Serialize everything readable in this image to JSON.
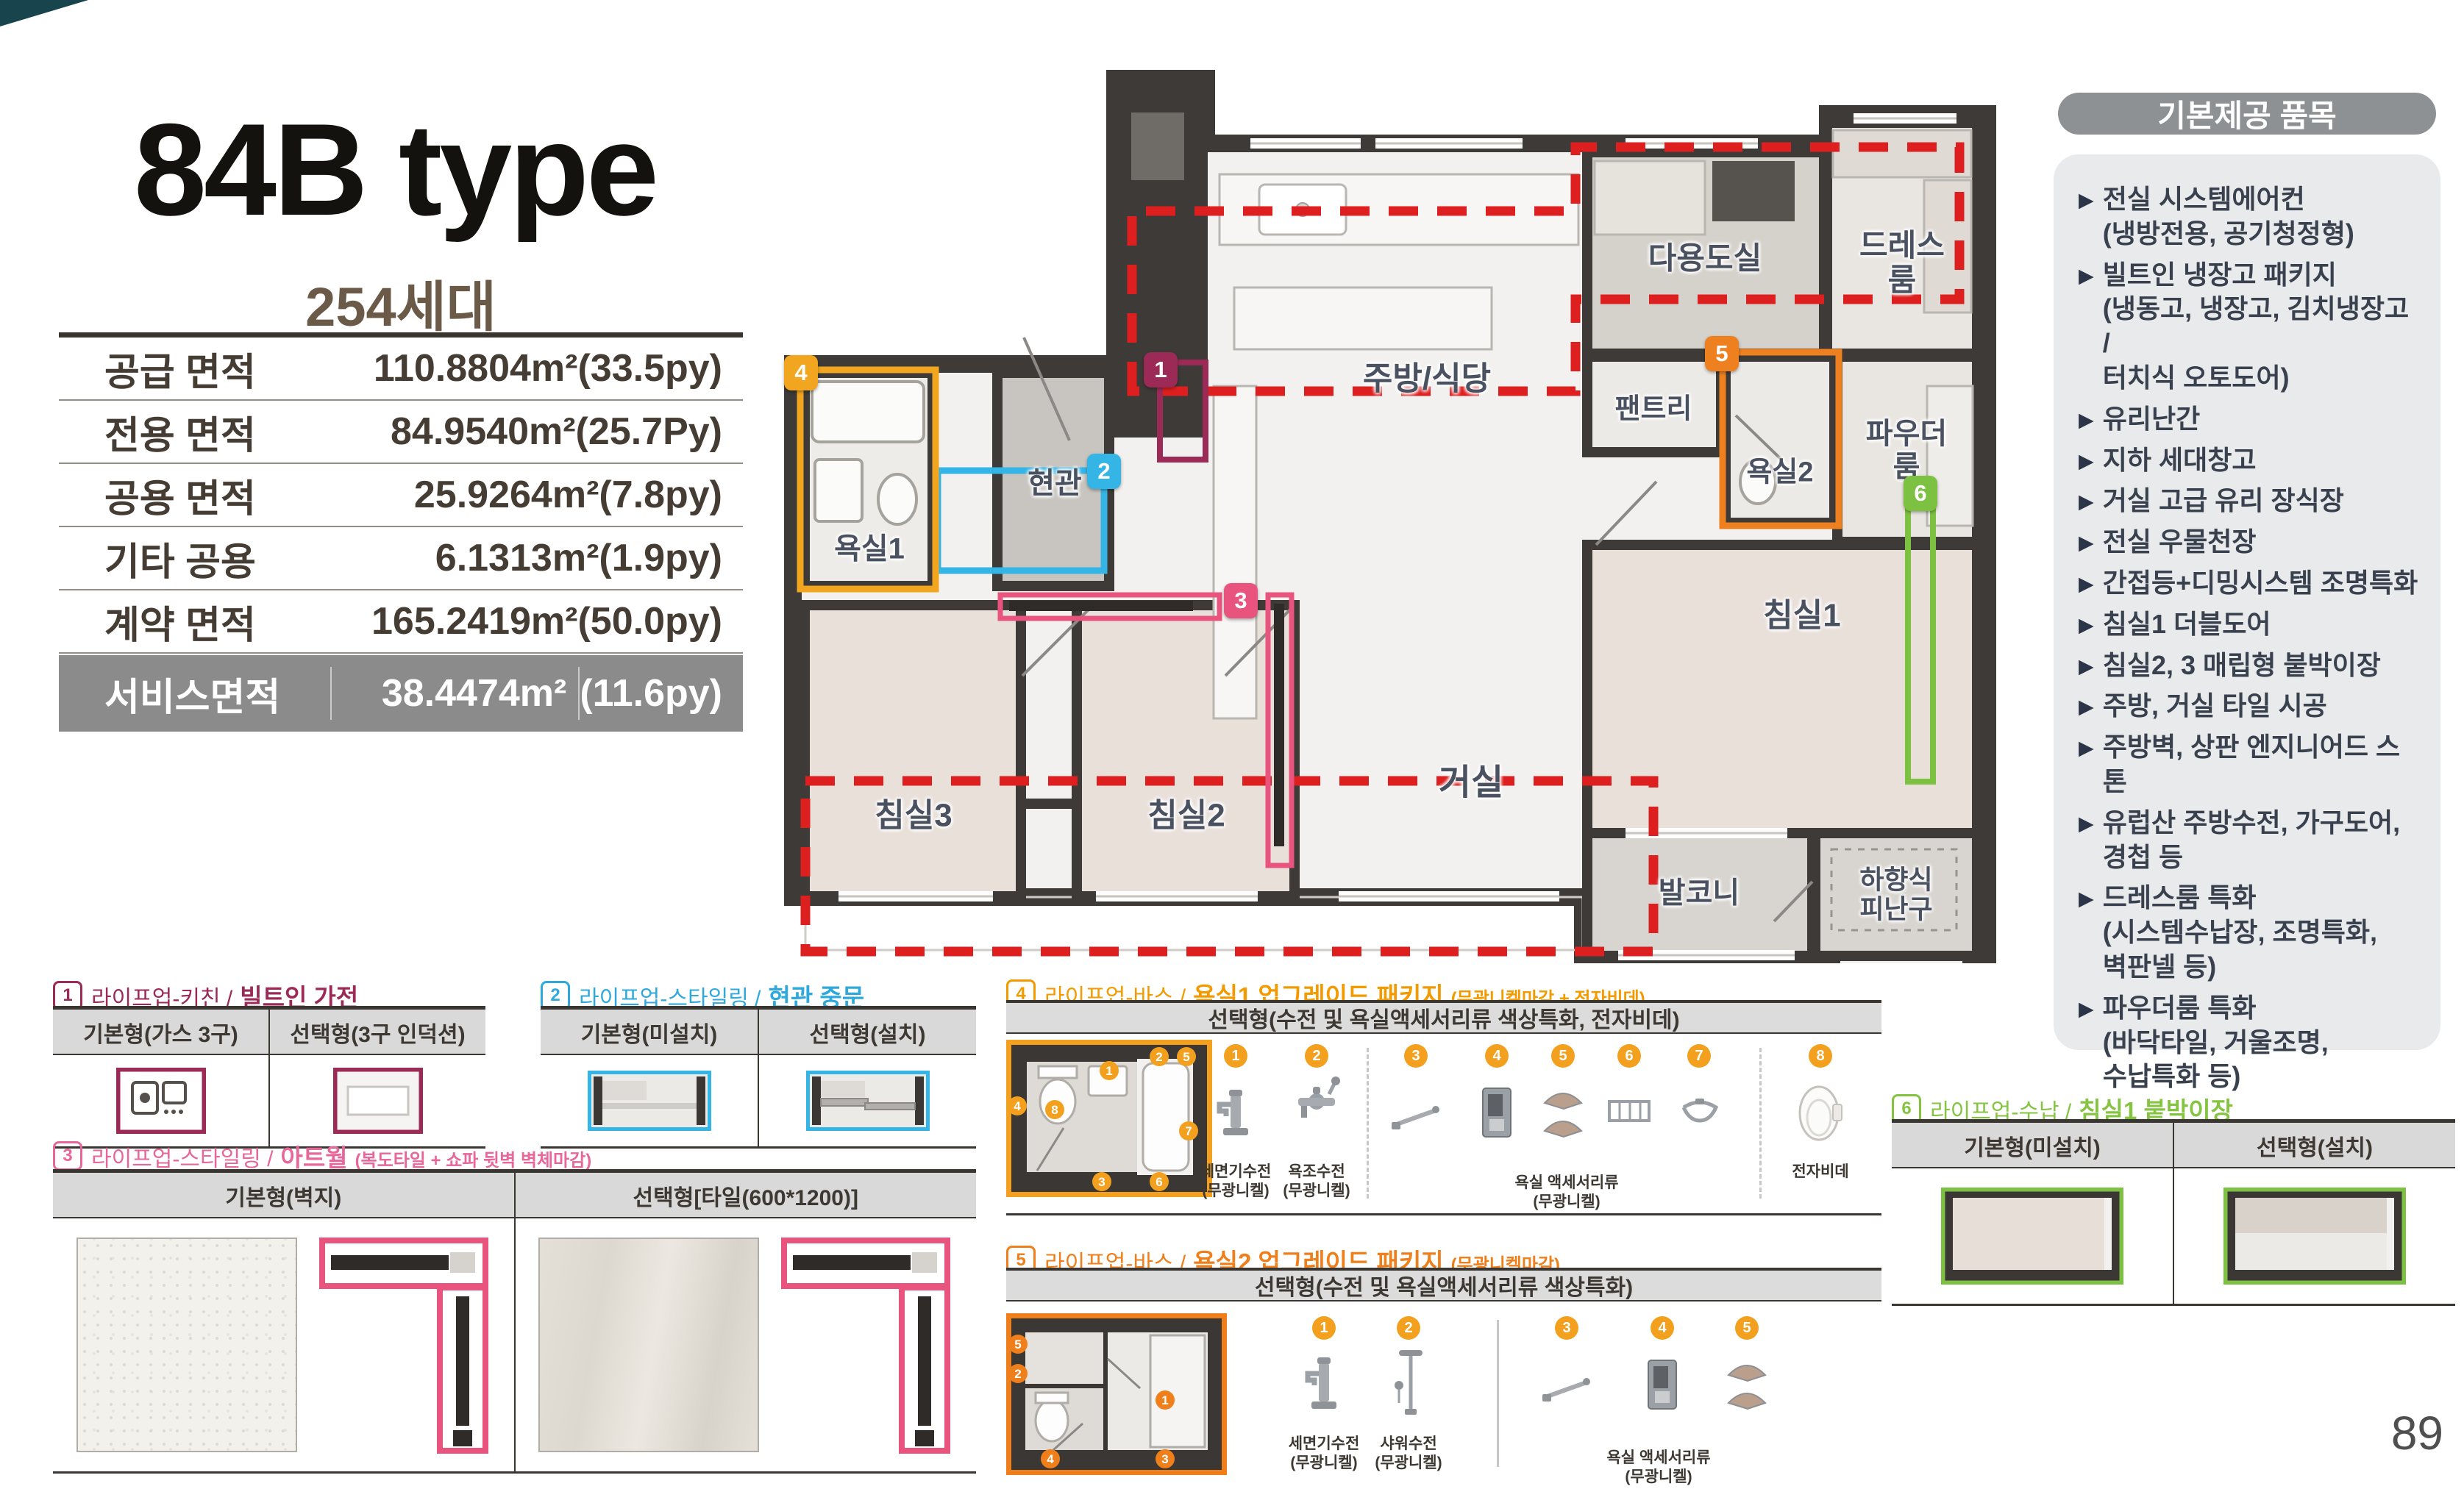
{
  "page": {
    "number": "89"
  },
  "header": {
    "title": "84B type",
    "units": "254세대"
  },
  "area_table": {
    "rows": [
      {
        "label": "공급 면적",
        "value": "110.8804m²",
        "py": "(33.5py)"
      },
      {
        "label": "전용 면적",
        "value": "84.9540m²",
        "py": "(25.7Py)"
      },
      {
        "label": "공용 면적",
        "value": "25.9264m²",
        "py": "(7.8py)"
      },
      {
        "label": "기타 공용",
        "value": "6.1313m²",
        "py": "(1.9py)"
      },
      {
        "label": "계약 면적",
        "value": "165.2419m²",
        "py": "(50.0py)"
      },
      {
        "label": "서비스면적",
        "value": "38.4474m²",
        "py": "(11.6py)"
      }
    ]
  },
  "provided": {
    "title": "기본제공 품목",
    "items": [
      "전실 시스템에어컨\n(냉방전용, 공기청정형)",
      "빌트인 냉장고 패키지\n(냉동고, 냉장고, 김치냉장고 /\n 터치식 오토도어)",
      "유리난간",
      "지하 세대창고",
      "거실 고급 유리 장식장",
      "전실 우물천장",
      "간접등+디밍시스템 조명특화",
      "침실1 더블도어",
      "침실2, 3 매립형 붙박이장",
      "주방, 거실 타일 시공",
      "주방벽, 상판 엔지니어드 스톤",
      "유럽산 주방수전, 가구도어,\n경첩 등",
      "드레스룸 특화\n(시스템수납장, 조명특화,\n 벽판넬 등)",
      "파우더룸 특화\n(바닥타일, 거울조명,\n 수납특화 등)"
    ]
  },
  "floorplan": {
    "rooms": [
      "현관",
      "욕실1",
      "침실3",
      "침실2",
      "거실",
      "주방/식당",
      "다용도실",
      "팬트리",
      "드레스룸",
      "욕실2",
      "파우더룸",
      "침실1",
      "발코니",
      "하향식\n피난구"
    ],
    "markers": [
      "1",
      "2",
      "3",
      "4",
      "5",
      "6"
    ]
  },
  "colors": {
    "s1_maroon": "#9b2a57",
    "s2_cyan": "#35b5e5",
    "s3_pink": "#e8547e",
    "s4_amber": "#f2a01d",
    "s5_orange": "#ef7f1a",
    "s6_green": "#7dc143",
    "red_dash": "#de1f1f",
    "sidebar_gray": "#8e9194",
    "service_row_gray": "#8b8b8b"
  },
  "sections": {
    "s1": {
      "num": "1",
      "cat": "라이프업-키친 /",
      "name": "빌트인 가전",
      "cols": [
        "기본형(가스 3구)",
        "선택형(3구 인덕션)"
      ]
    },
    "s2": {
      "num": "2",
      "cat": "라이프업-스타일링 /",
      "name": "현관 중문",
      "cols": [
        "기본형(미설치)",
        "선택형(설치)"
      ]
    },
    "s3": {
      "num": "3",
      "cat": "라이프업-스타일링 /",
      "name": "아트월",
      "note": "(복도타일 + 쇼파 뒷벽 벽체마감)",
      "cols": [
        "기본형(벽지)",
        "선택형[타일(600*1200)]"
      ]
    },
    "s4": {
      "num": "4",
      "cat": "라이프업-바스 /",
      "name": "욕실1 업그레이드 패키지",
      "note": "(무광니켈마감 + 전자비데)",
      "header": "선택형(수전 및 욕실액세서리류 색상특화, 전자비데)",
      "badges": [
        "1",
        "2",
        "3",
        "4",
        "5",
        "6",
        "7",
        "8"
      ],
      "label1": "세면기수전\n(무광니켈)",
      "label2": "욕조수전\n(무광니켈)",
      "group_label": "욕실 액세서리류\n(무광니켈)",
      "label8": "전자비데"
    },
    "s5": {
      "num": "5",
      "cat": "라이프업-바스 /",
      "name": "욕실2 업그레이드 패키지",
      "note": "(무광니켈마감)",
      "header": "선택형(수전 및 욕실액세서리류 색상특화)",
      "badges": [
        "1",
        "2",
        "3",
        "4",
        "5"
      ],
      "label1": "세면기수전\n(무광니켈)",
      "label2": "샤워수전\n(무광니켈)",
      "group_label": "욕실 액세서리류\n(무광니켈)"
    },
    "s6": {
      "num": "6",
      "cat": "라이프업-수납 /",
      "name": "침실1 붙박이장",
      "cols": [
        "기본형(미설치)",
        "선택형(설치)"
      ]
    }
  }
}
